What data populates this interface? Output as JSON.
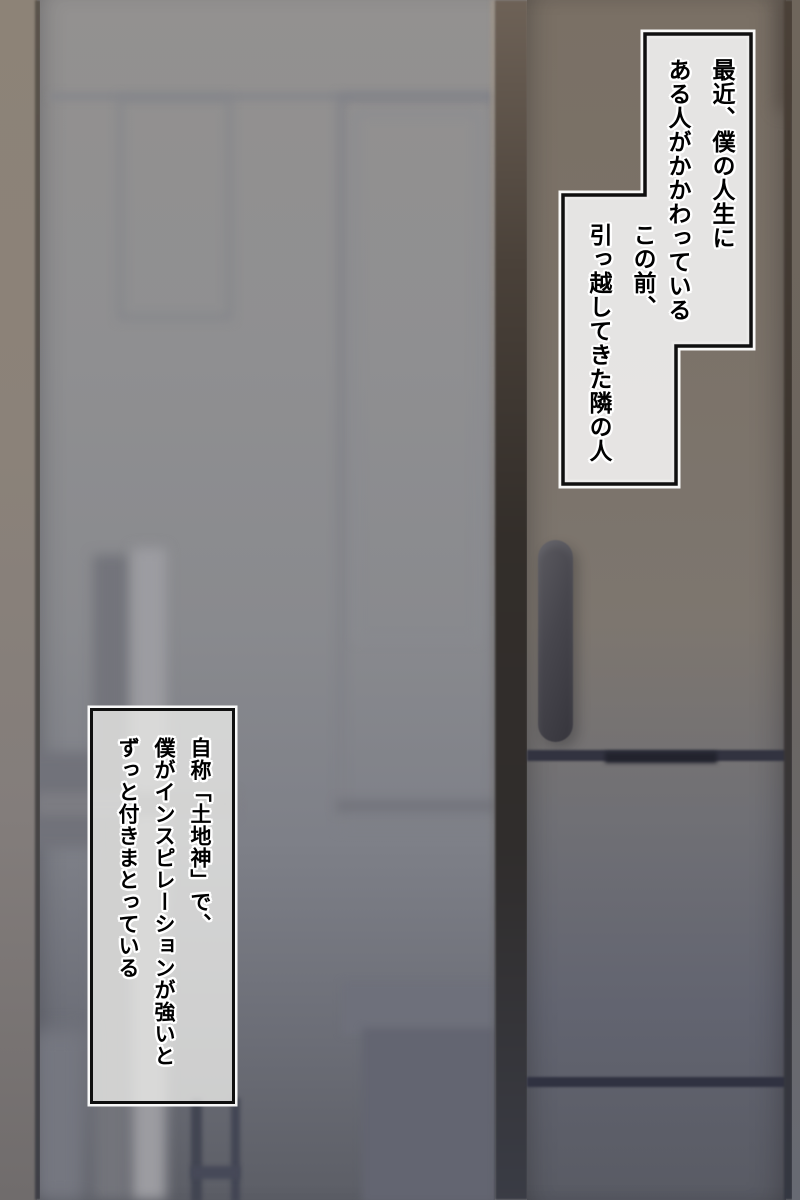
{
  "page": {
    "language": "ja",
    "writing_mode": "vertical-rl"
  },
  "narration": {
    "box_recently": {
      "lines": [
        "最近、僕の人生に",
        "ある人がかかわっている"
      ]
    },
    "box_neighbor": {
      "lines": [
        "この前、",
        "引っ越してきた隣の人"
      ]
    },
    "box_self_proclaimed": {
      "lines": [
        "自称「土地神」で、",
        "僕がインスピレーションが強いと",
        "ずっと付きまとっている"
      ]
    }
  },
  "colors": {
    "bubble_fill": "#d9d7d5",
    "bubble_border": "#111111",
    "bubble_halo": "#ffffff",
    "text": "#000000",
    "left_wall": "#8d8377",
    "frosted_glass": "#8e8e90",
    "door_frame": "#332e2a",
    "fridge_door": "#7b7268",
    "fridge_handle": "#46454c",
    "door_seam": "#323340"
  }
}
